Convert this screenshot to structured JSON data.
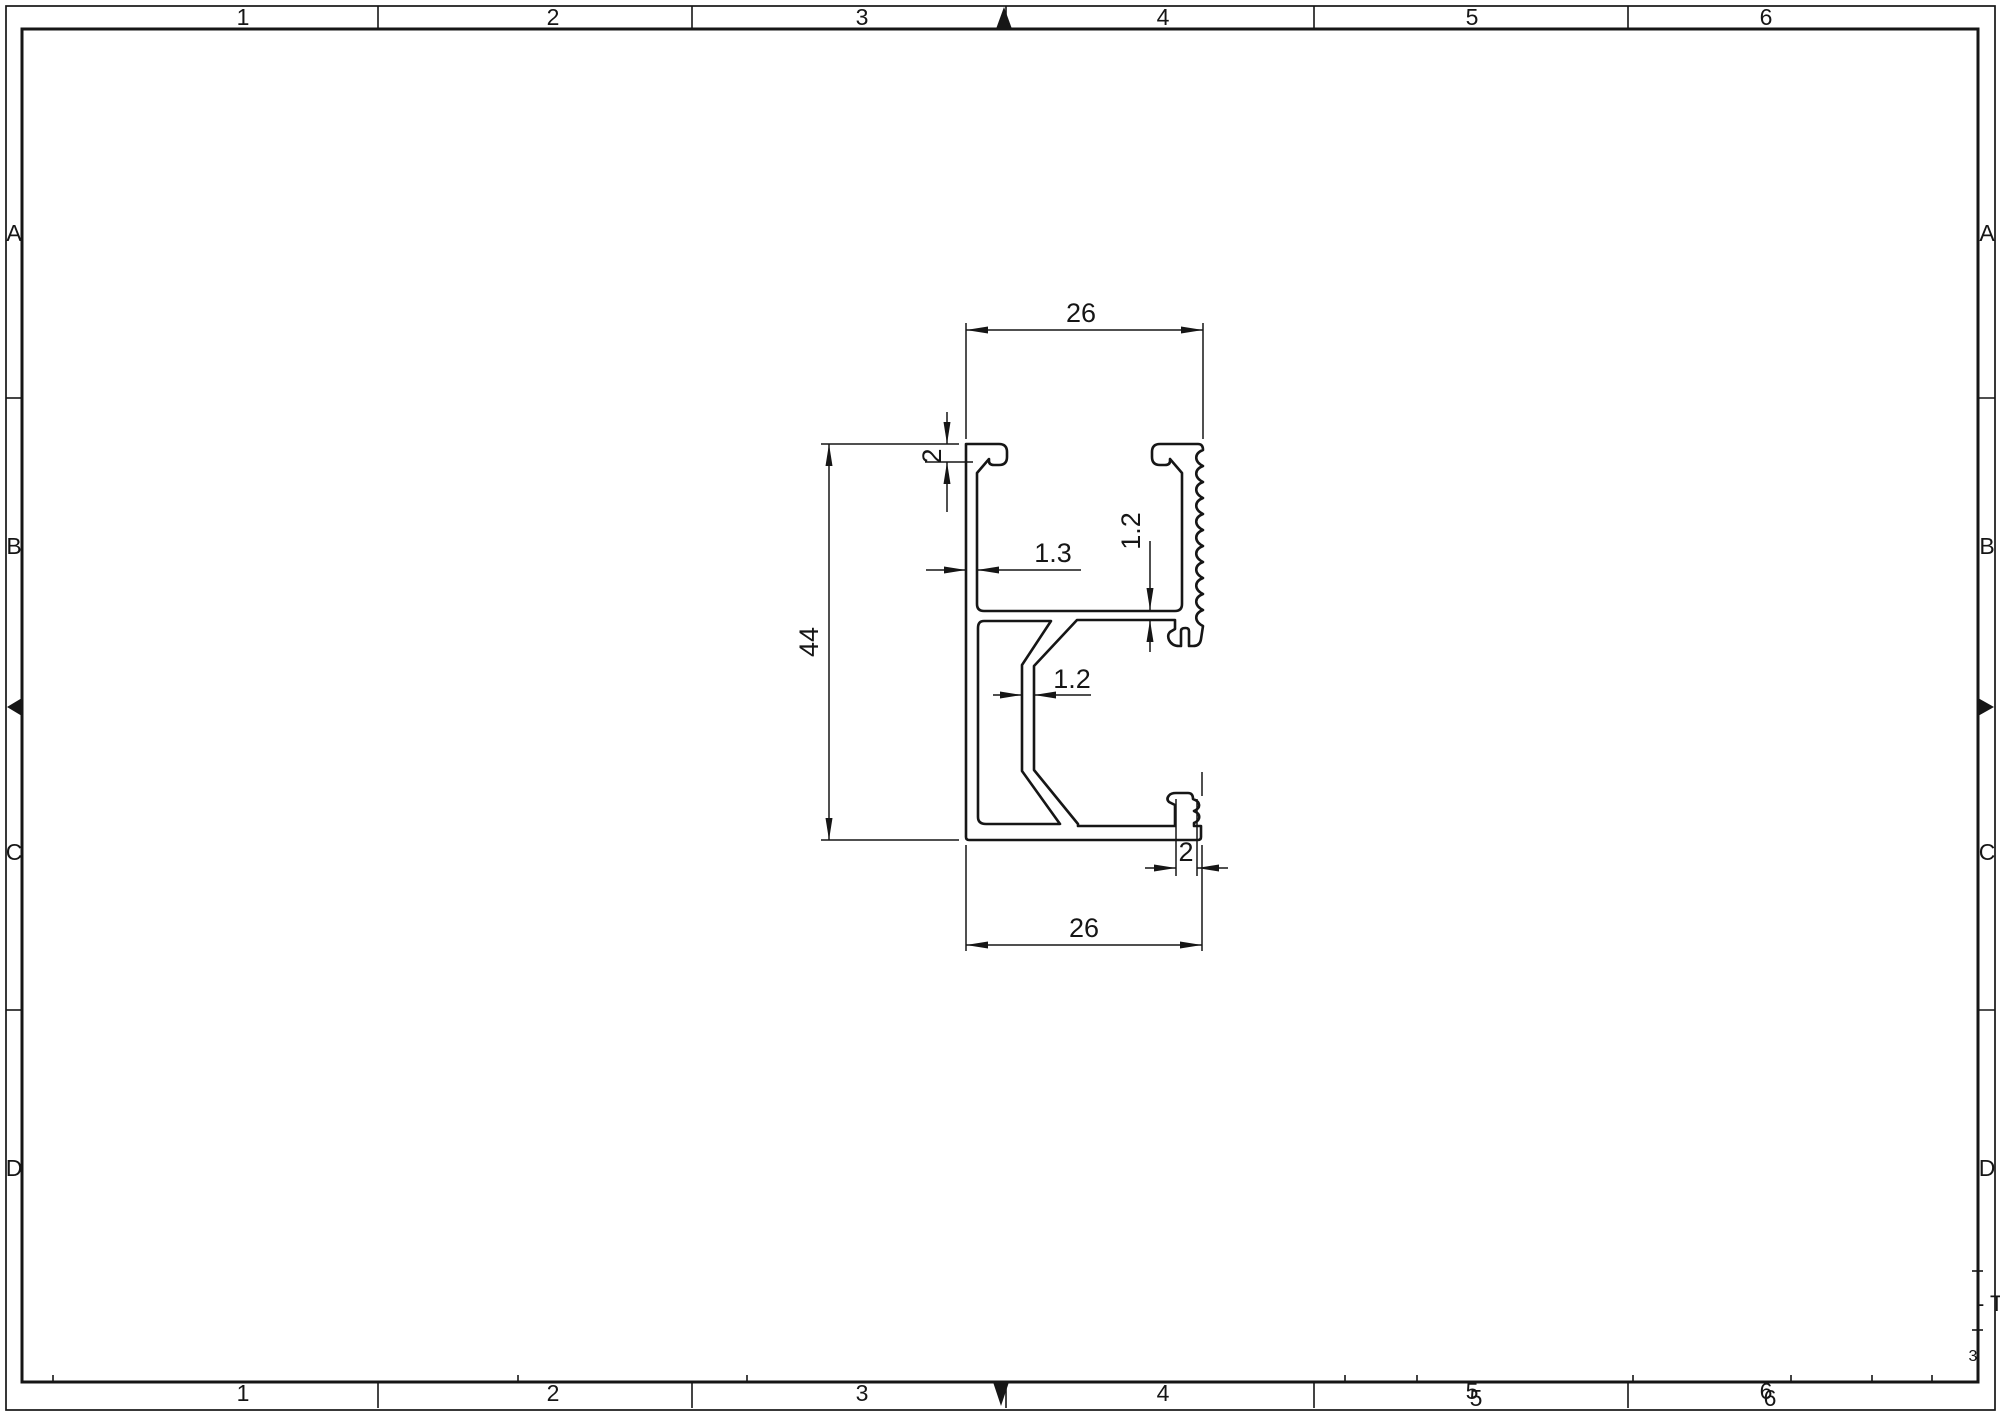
{
  "sheet": {
    "bg": "#ffffff",
    "line_color": "#161616",
    "zones": {
      "columns": [
        "1",
        "2",
        "3",
        "4",
        "5",
        "6"
      ],
      "rows": [
        "A",
        "B",
        "C",
        "D"
      ]
    },
    "title_fragment": {
      "text": "- T",
      "mark": "3"
    }
  },
  "dimensions": {
    "top_width": "26",
    "bottom_width": "26",
    "overall_height": "44",
    "top_flange_thickness": "2",
    "left_wall_thickness": "1.3",
    "channel_floor_thickness": "1.2",
    "web_thickness": "1.2",
    "bottom_lip_thickness": "2"
  }
}
